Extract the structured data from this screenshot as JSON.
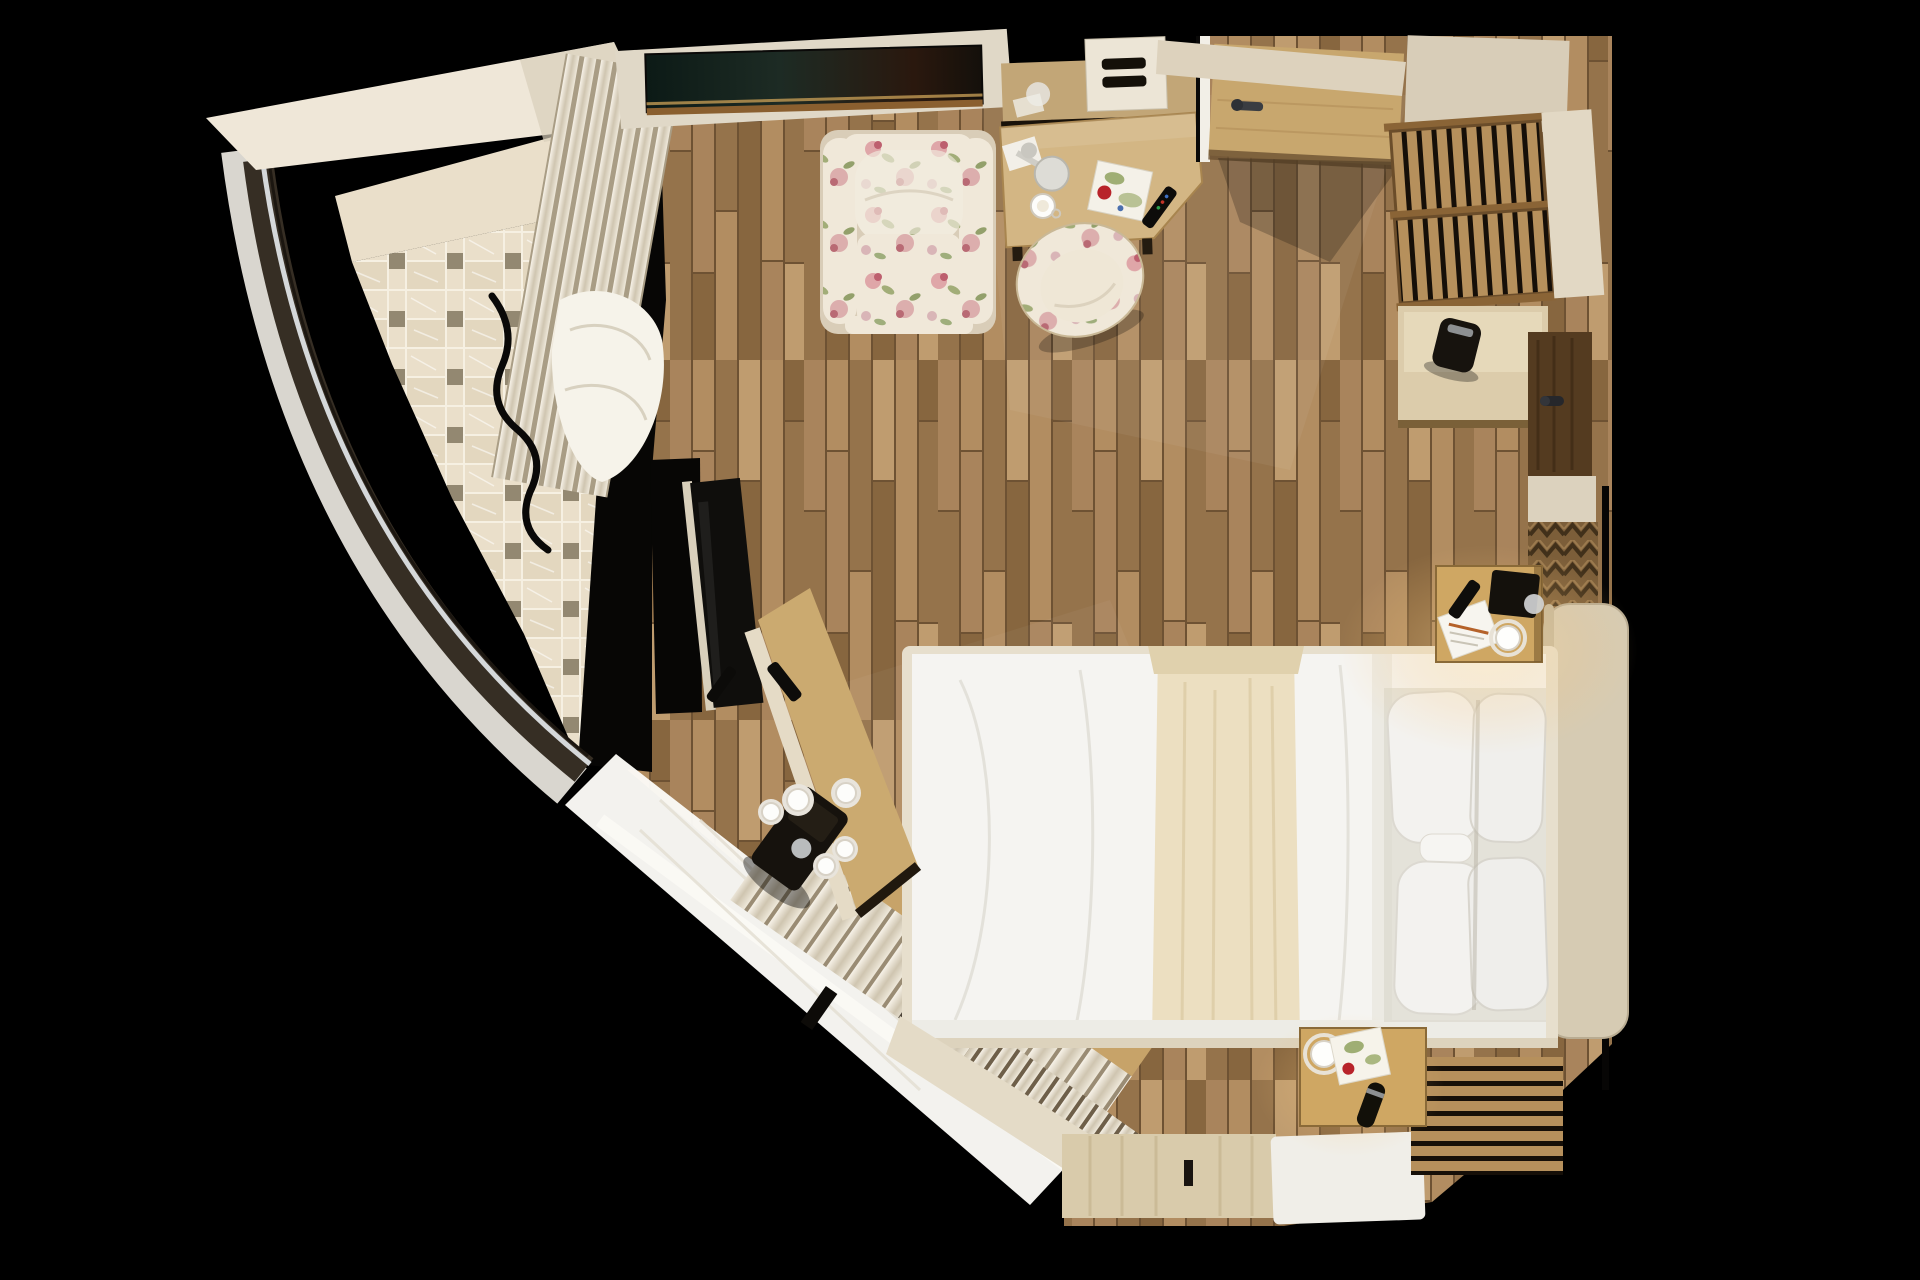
{
  "meta": {
    "image_type": "photorealistic top-down 3D render",
    "subject": "hotel bedroom floor plan seen from directly above",
    "background": "black",
    "canvas": {
      "width": 1920,
      "height": 1280
    }
  },
  "palette": {
    "bg": "#000000",
    "wood-a": "#a9845c",
    "wood-b": "#95734b",
    "wood-c": "#b28d61",
    "wood-d": "#87663f",
    "wood-light": "#bf9c6f",
    "wood-gap": "#6e5233",
    "wood-door": "#c8a76e",
    "wood-maple": "#d3b684",
    "wood-console": "#cbaa70",
    "tile-grout": "#f6f0e2",
    "tile-base": "#eadfca",
    "tile-alt": "#e3d7bf",
    "tile-dot": "#938871",
    "cream": "#efe7d8",
    "white-linen": "#f5f4f1",
    "pillow": "#f3f2ef",
    "beige-wall": "#e4dbc7",
    "sill": "#d9d6cf",
    "window-frame": "#362e24",
    "glazing": "#d5d8da",
    "near-black": "#070605",
    "dark-furniture": "#14110c",
    "runner": "#ecdfc1",
    "headboard": "#d6cbb3",
    "slat": "#b6905c",
    "floral-base": "#f0e8d9",
    "accent-red": "#b8232a",
    "glow": "#ffe2a6"
  },
  "objects": [
    {
      "name": "curved-window-wall",
      "description": "dark-framed curved glazing along the left side with pale outer sill"
    },
    {
      "name": "mosaic-tile-floor",
      "description": "beige marble basketweave mosaic with small grey dot tiles, wedge-shaped bathroom/balcony floor"
    },
    {
      "name": "parquet-floor",
      "description": "oak plank flooring covering the main room"
    },
    {
      "name": "drape-stack",
      "description": "cream pleated curtains bunched along upper-left wall"
    },
    {
      "name": "wall-art-console",
      "description": "dark marble-topped piece with bronze trim on the top wall"
    },
    {
      "name": "floral-armchair",
      "description": "cream armchair with pink/green floral upholstery"
    },
    {
      "name": "writing-desk",
      "description": "maple desk with lamp, magazine, coffee cup and remote; mirror strip above"
    },
    {
      "name": "floral-desk-chair",
      "description": "floral tub chair pulled up to the desk"
    },
    {
      "name": "entry-door",
      "description": "light wood door swung open with dark handle"
    },
    {
      "name": "luggage-bench",
      "description": "two slatted wood racks in the top-right corner"
    },
    {
      "name": "minibar-cabinet",
      "description": "low cabinet with kettle on the right wall"
    },
    {
      "name": "bathroom-door",
      "description": "dark wood door on the right wall with handle"
    },
    {
      "name": "carved-chevron-panel",
      "description": "zigzag carved wood wall panel near the headboard"
    },
    {
      "name": "double-bed",
      "description": "white duvet, beige runner across the foot, four white pillows, beige upholstered headboard"
    },
    {
      "name": "nightstand-top",
      "description": "lit nightstand with notepad, pencil, remote, clock and cup"
    },
    {
      "name": "nightstand-bottom",
      "description": "lit nightstand with cup, floral card and torch"
    },
    {
      "name": "tv-panel",
      "description": "flat TV on the angled media console, remote resting on it"
    },
    {
      "name": "media-console",
      "description": "angled wood counter with coffee machine and five white cups"
    },
    {
      "name": "sheer-curtain",
      "description": "large white sheer fabric along the bottom-left window"
    },
    {
      "name": "pleated-curtain-rolls",
      "description": "rows of rolled curtain pleats along the diagonal window"
    },
    {
      "name": "threshold-panel",
      "description": "light wood floor hatch with small dark handle at bottom centre"
    },
    {
      "name": "white-rug",
      "description": "small white rug at the bottom edge"
    }
  ]
}
